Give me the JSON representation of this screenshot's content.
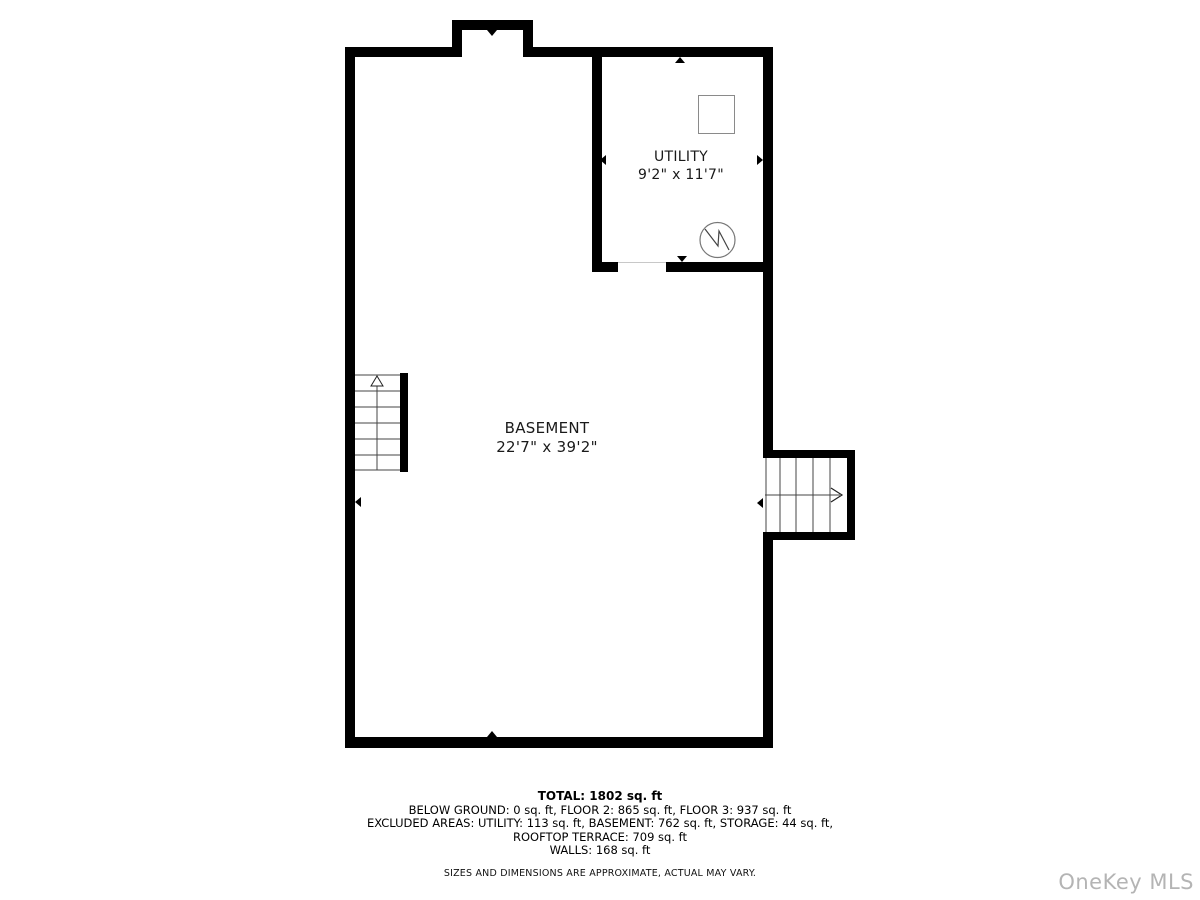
{
  "title": "Basement floor plan",
  "floor_plan": {
    "rooms": [
      {
        "name": "BASEMENT",
        "dimensions": "22'7\" x 39'2\""
      },
      {
        "name": "UTILITY",
        "dimensions": "9'2\" x 11'7\""
      }
    ],
    "stairs": [
      {
        "id": "left-staircase",
        "direction": "up"
      },
      {
        "id": "right-staircase",
        "direction": "right"
      }
    ],
    "symbols": [
      {
        "name": "water-heater-square"
      },
      {
        "name": "electric-meter-circle"
      }
    ]
  },
  "summary": {
    "total": "TOTAL: 1802 sq. ft",
    "below_ground_line": "BELOW GROUND: 0 sq. ft, FLOOR 2: 865 sq. ft, FLOOR 3: 937 sq. ft",
    "excluded_line": "EXCLUDED AREAS: UTILITY: 113 sq. ft, BASEMENT: 762 sq. ft, STORAGE: 44 sq. ft,",
    "rooftop_line": "ROOFTOP TERRACE: 709 sq. ft",
    "walls_line": "WALLS: 168 sq. ft",
    "disclaimer": "SIZES AND DIMENSIONS ARE APPROXIMATE, ACTUAL MAY VARY."
  },
  "watermark": {
    "text": "OneKey MLS"
  },
  "colors": {
    "wall": "#000000",
    "stair_line": "#444444",
    "symbol_stroke": "#777777",
    "watermark": "#b4b4b4"
  }
}
